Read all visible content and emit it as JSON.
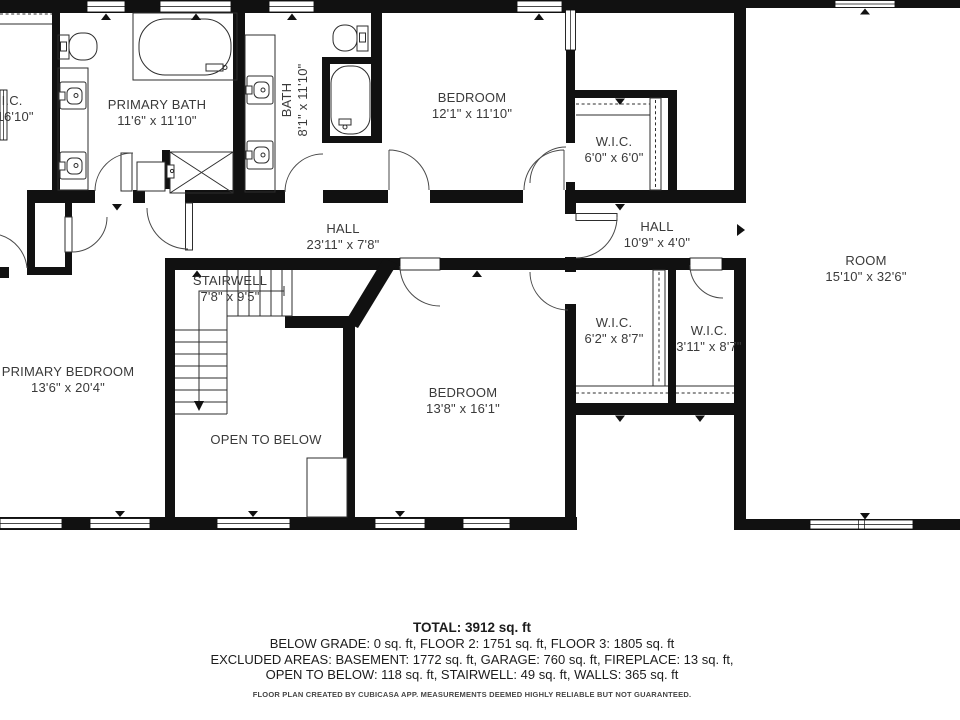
{
  "rooms": [
    {
      "id": "wic-left",
      "name": "W.I.C.",
      "dims": "x 16'10\""
    },
    {
      "id": "primary-bath",
      "name": "PRIMARY BATH",
      "dims": "11'6\" x 11'10\""
    },
    {
      "id": "bath",
      "name": "BATH",
      "dims": "8'1\" x 11'10\""
    },
    {
      "id": "bedroom-1",
      "name": "BEDROOM",
      "dims": "12'1\" x 11'10\""
    },
    {
      "id": "wic-2",
      "name": "W.I.C.",
      "dims": "6'0\" x 6'0\""
    },
    {
      "id": "hall-1",
      "name": "HALL",
      "dims": "23'11\" x 7'8\""
    },
    {
      "id": "hall-2",
      "name": "HALL",
      "dims": "10'9\" x 4'0\""
    },
    {
      "id": "room",
      "name": "ROOM",
      "dims": "15'10\" x 32'6\""
    },
    {
      "id": "stairwell",
      "name": "STAIRWELL",
      "dims": "7'8\" x 9'5\""
    },
    {
      "id": "primary-bedroom",
      "name": "PRIMARY BEDROOM",
      "dims": "13'6\" x 20'4\""
    },
    {
      "id": "open-to-below",
      "name": "OPEN TO BELOW",
      "dims": ""
    },
    {
      "id": "bedroom-2",
      "name": "BEDROOM",
      "dims": "13'8\" x 16'1\""
    },
    {
      "id": "wic-3",
      "name": "W.I.C.",
      "dims": "6'2\" x 8'7\""
    },
    {
      "id": "wic-4",
      "name": "W.I.C.",
      "dims": "3'11\" x 8'7\""
    }
  ],
  "footer": {
    "total": "TOTAL: 3912 sq. ft",
    "line2": "BELOW GRADE: 0 sq. ft, FLOOR 2: 1751 sq. ft, FLOOR 3: 1805 sq. ft",
    "line3": "EXCLUDED AREAS: BASEMENT: 1772 sq. ft, GARAGE: 760 sq. ft, FIREPLACE: 13 sq. ft,",
    "line4": "OPEN TO BELOW: 118 sq. ft, STAIRWELL: 49 sq. ft, WALLS: 365 sq. ft",
    "disclaimer": "FLOOR PLAN CREATED BY CUBICASA APP. MEASUREMENTS DEEMED HIGHLY RELIABLE BUT NOT GUARANTEED."
  },
  "colors": {
    "wall": "#111111",
    "line": "#2d2d2d",
    "arc": "#4a4a4a",
    "text": "#3a3a3a"
  }
}
